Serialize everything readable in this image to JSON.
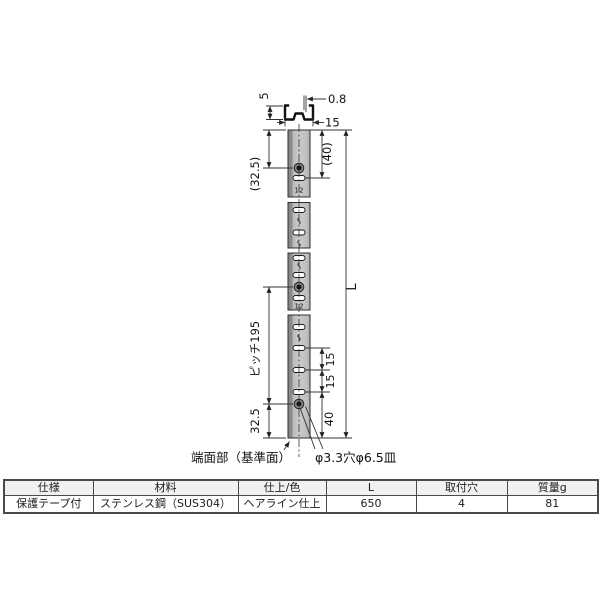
{
  "drawing": {
    "section": {
      "height": "5",
      "thickness": "0.8",
      "width": "15"
    },
    "left_dims": {
      "top_end_to_hole": "(32.5)",
      "hole_pitch": "ピッチ195",
      "bottom_hole_to_end": "32.5"
    },
    "right_dims": {
      "top_end_to_slot": "(40)",
      "overall_length": "L",
      "slot_pitch_a": "15",
      "slot_pitch_b": "15",
      "bottom_slot_to_end": "40"
    },
    "inline_dims": {
      "hole_to_slot_top": "12",
      "hole_to_slot_mid": "12"
    },
    "callouts": {
      "end_face": "端面部（基準面）",
      "hole_spec": "φ3.3穴φ6.5皿"
    }
  },
  "table": {
    "headers": [
      "仕様",
      "材料",
      "仕上/色",
      "L",
      "取付穴",
      "質量g"
    ],
    "rows": [
      [
        "保護テープ付",
        "ステンレス鋼（SUS304）",
        "ヘアライン仕上",
        "650",
        "4",
        "81"
      ]
    ]
  },
  "colors": {
    "line": "#333333",
    "rail_fill": "#c6c6c6",
    "rail_edge": "#8a8a8a",
    "table_border": "#4a4a4a",
    "header_bg": "#f1f1f1"
  }
}
